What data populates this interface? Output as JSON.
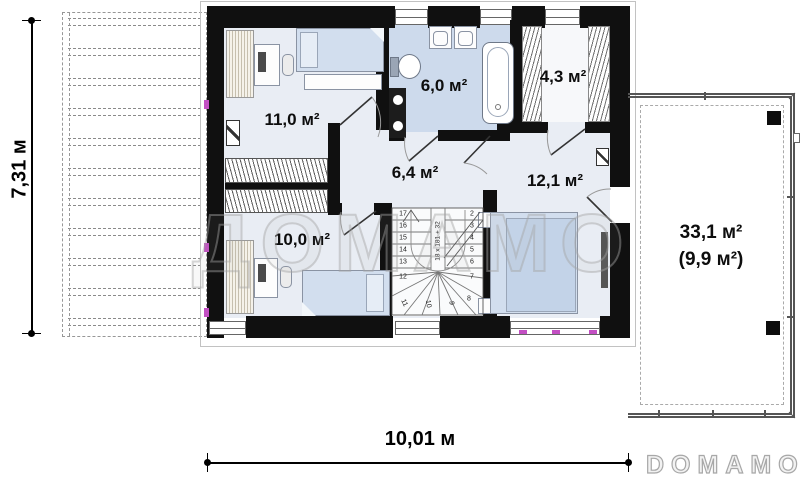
{
  "dimensions": {
    "vertical": "7,31 м",
    "horizontal": "10,01 м"
  },
  "rooms": {
    "bedroom_top_left": {
      "label": "11,0 м²"
    },
    "bathroom": {
      "label": "6,0 м²"
    },
    "closet": {
      "label": "4,3 м²"
    },
    "hall": {
      "label": "6,4 м²"
    },
    "bedroom_right": {
      "label": "12,1 м²"
    },
    "bedroom_bottom_left": {
      "label": "10,0 м²"
    },
    "terrace": {
      "label_total": "33,1 м²",
      "label_usable": "(9,9 м²)"
    }
  },
  "stairs": {
    "annotation": "18 x 181 + 32",
    "step_numbers": [
      "17",
      "16",
      "15",
      "14",
      "13",
      "12",
      "11",
      "10",
      "9",
      "8",
      "7",
      "6",
      "5",
      "4",
      "3",
      "2"
    ]
  },
  "watermark": {
    "text": "ДОМАМО"
  },
  "brand": {
    "logo": "DOMAMO"
  },
  "colors": {
    "wall": "#101010",
    "floor": "#e9edf4",
    "bathroom_floor": "#cddaec",
    "bed_fill": "#d2deee",
    "watermark_gray": "#a5a5a5",
    "marker_magenta": "#c34fc3"
  }
}
